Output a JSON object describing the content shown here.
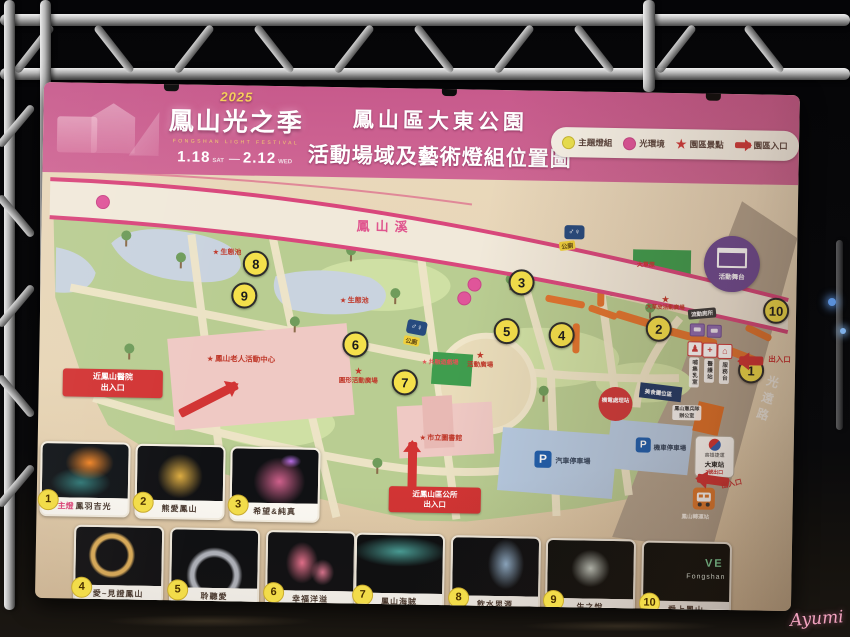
{
  "watermark": "Ayumi",
  "header": {
    "logo": {
      "year": "2025",
      "title": "鳳山光之季",
      "subtitle": "FONGSHAN LIGHT FESTIVAL",
      "date_start": "1.18",
      "date_start_day": "SAT",
      "date_end": "2.12",
      "date_end_day": "WED"
    },
    "title_line1": "鳳山區大東公園",
    "title_line2": "活動場域及藝術燈組位置圖",
    "legend": [
      {
        "label": "主題燈組"
      },
      {
        "label": "光環境"
      },
      {
        "label": "園區景點"
      },
      {
        "label": "園區入口"
      }
    ]
  },
  "map": {
    "river": "鳳山溪",
    "road": "光遠路",
    "markers": [
      {
        "n": "1"
      },
      {
        "n": "2"
      },
      {
        "n": "3"
      },
      {
        "n": "4"
      },
      {
        "n": "5"
      },
      {
        "n": "6"
      },
      {
        "n": "7"
      },
      {
        "n": "8"
      },
      {
        "n": "9"
      },
      {
        "n": "10"
      }
    ],
    "stars": [
      {
        "label": "生態池"
      },
      {
        "label": "生態池"
      },
      {
        "label": "鳳山老人活動中心"
      },
      {
        "label": "圓形活動廣場"
      },
      {
        "label": "共融遊戲場"
      },
      {
        "label": "活動廣場"
      },
      {
        "label": "市立圖書館"
      },
      {
        "label": "大草皮活動廣場"
      }
    ],
    "grass_label": "大草原",
    "facilities": {
      "toilet": "公廁",
      "stage": "活動舞台",
      "portable_toilet": "流動廁所",
      "nursing": "哺集乳室",
      "medical": "醫護站",
      "info": "服務台",
      "car_parking": "汽車停車場",
      "moto_parking": "機車停車場",
      "mrt_line1": "高雄捷運",
      "mrt_line2": "大東站",
      "mrt_exit": "2號出口",
      "bus": "鳳山轉運站",
      "booth": "美食攤位區",
      "power": "機電處理站",
      "mp_line1": "鳳山憲兵隊",
      "mp_line2": "辦公室"
    },
    "entrances": {
      "hospital": "近鳳山醫院\n出入口",
      "office": "近鳳山區公所\n出入口",
      "east": "出入口",
      "mrt_side": "出入口"
    }
  },
  "thumbnails": [
    {
      "n": "1",
      "tag": "主燈",
      "name": "鳳羽吉光"
    },
    {
      "n": "2",
      "name": "熊愛鳳山"
    },
    {
      "n": "3",
      "name": "希望&純真"
    },
    {
      "n": "4",
      "name": "愛~見證鳳山"
    },
    {
      "n": "5",
      "name": "聆聽愛"
    },
    {
      "n": "6",
      "name": "幸福洋溢"
    },
    {
      "n": "7",
      "name": "鳳山海賊"
    },
    {
      "n": "8",
      "name": "飲水思源"
    },
    {
      "n": "9",
      "name": "生之悅"
    },
    {
      "n": "10",
      "name": "愛上鳳山",
      "photo_line1": "VE",
      "photo_line2": "Fongshan"
    }
  ]
}
